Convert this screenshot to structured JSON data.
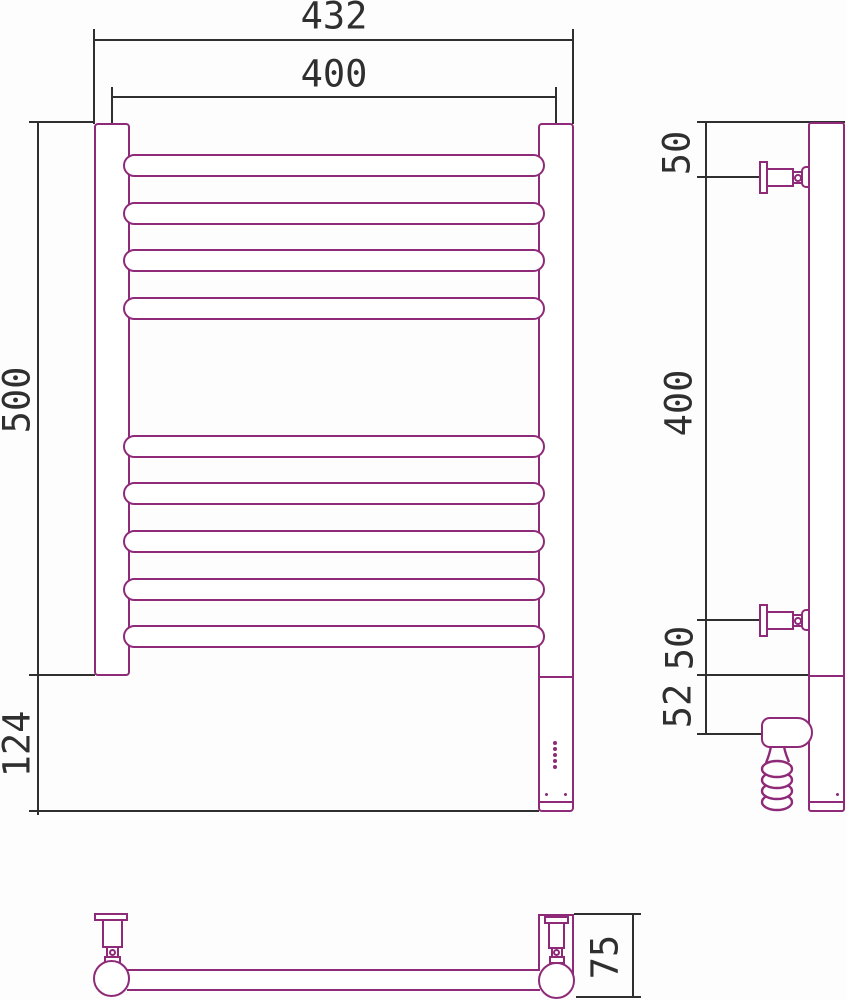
{
  "drawing": {
    "type": "technical-drawing",
    "subject": "heated-towel-rail",
    "units": "mm",
    "colors": {
      "product_outline": "#8e2a78",
      "dimension_lines": "#2f2f2f",
      "background": "#fdfdfe"
    },
    "front_view": {
      "overall_width": "432",
      "mounting_width": "400",
      "rail_section_height": "500",
      "lower_section_height": "124"
    },
    "side_view": {
      "top_bracket_offset": "50",
      "bracket_spacing": "400",
      "bottom_bracket_offset": "50",
      "heater_offset": "52"
    },
    "top_view": {
      "rail_depth": "75"
    }
  }
}
